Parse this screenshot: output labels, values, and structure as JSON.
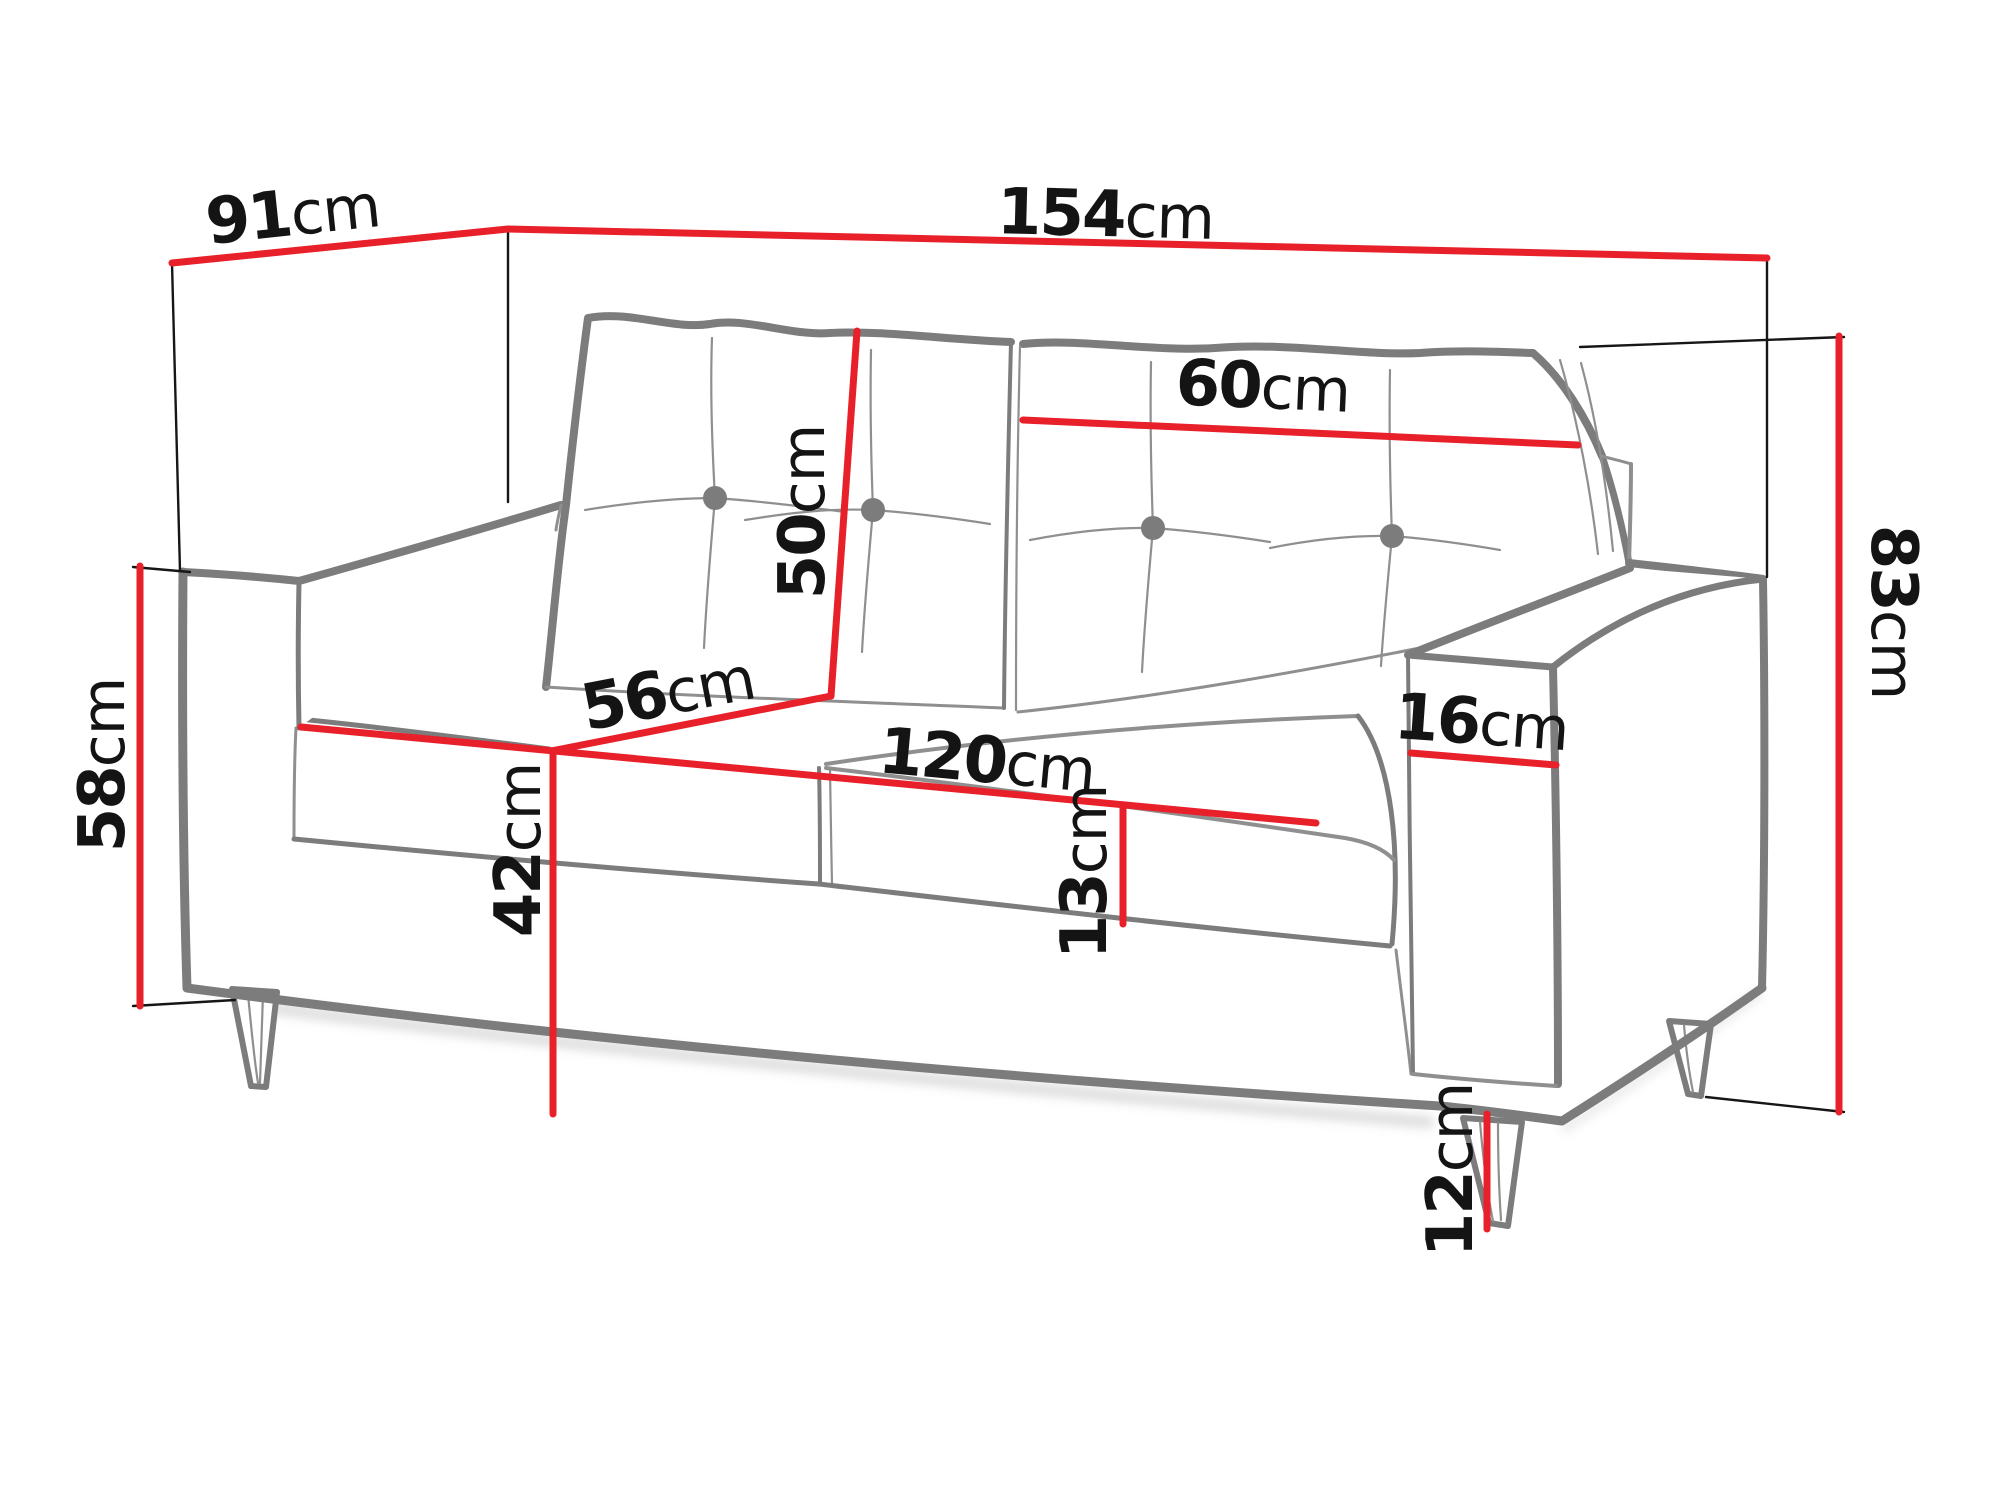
{
  "diagram": {
    "type": "furniture-dimensions",
    "subject": "Two-seat sofa line drawing with red dimension lines and measurement labels"
  },
  "colors": {
    "dimension_red": "#e8202a",
    "outline_gray": "#7c7c7c",
    "crease_gray": "#8f8f8f",
    "extension_black": "#161616",
    "label_black": "#141414",
    "shadow_gray": "#c2c2c2",
    "background": "#ffffff"
  },
  "measurements": {
    "total_depth": {
      "value": "91",
      "unit": "cm",
      "label": "91cm"
    },
    "total_width": {
      "value": "154",
      "unit": "cm",
      "label": "154cm"
    },
    "pillow_width": {
      "value": "60",
      "unit": "cm",
      "label": "60cm"
    },
    "pillow_height": {
      "value": "50",
      "unit": "cm",
      "label": "50cm"
    },
    "seat_depth": {
      "value": "56",
      "unit": "cm",
      "label": "56cm"
    },
    "arm_height": {
      "value": "58",
      "unit": "cm",
      "label": "58cm"
    },
    "armrest_width": {
      "value": "16",
      "unit": "cm",
      "label": "16cm"
    },
    "total_height": {
      "value": "83",
      "unit": "cm",
      "label": "83cm"
    },
    "seat_width": {
      "value": "120",
      "unit": "cm",
      "label": "120cm"
    },
    "seat_height": {
      "value": "42",
      "unit": "cm",
      "label": "42cm"
    },
    "cushion_thickness": {
      "value": "13",
      "unit": "cm",
      "label": "13cm"
    },
    "leg_height": {
      "value": "12",
      "unit": "cm",
      "label": "12cm"
    }
  }
}
